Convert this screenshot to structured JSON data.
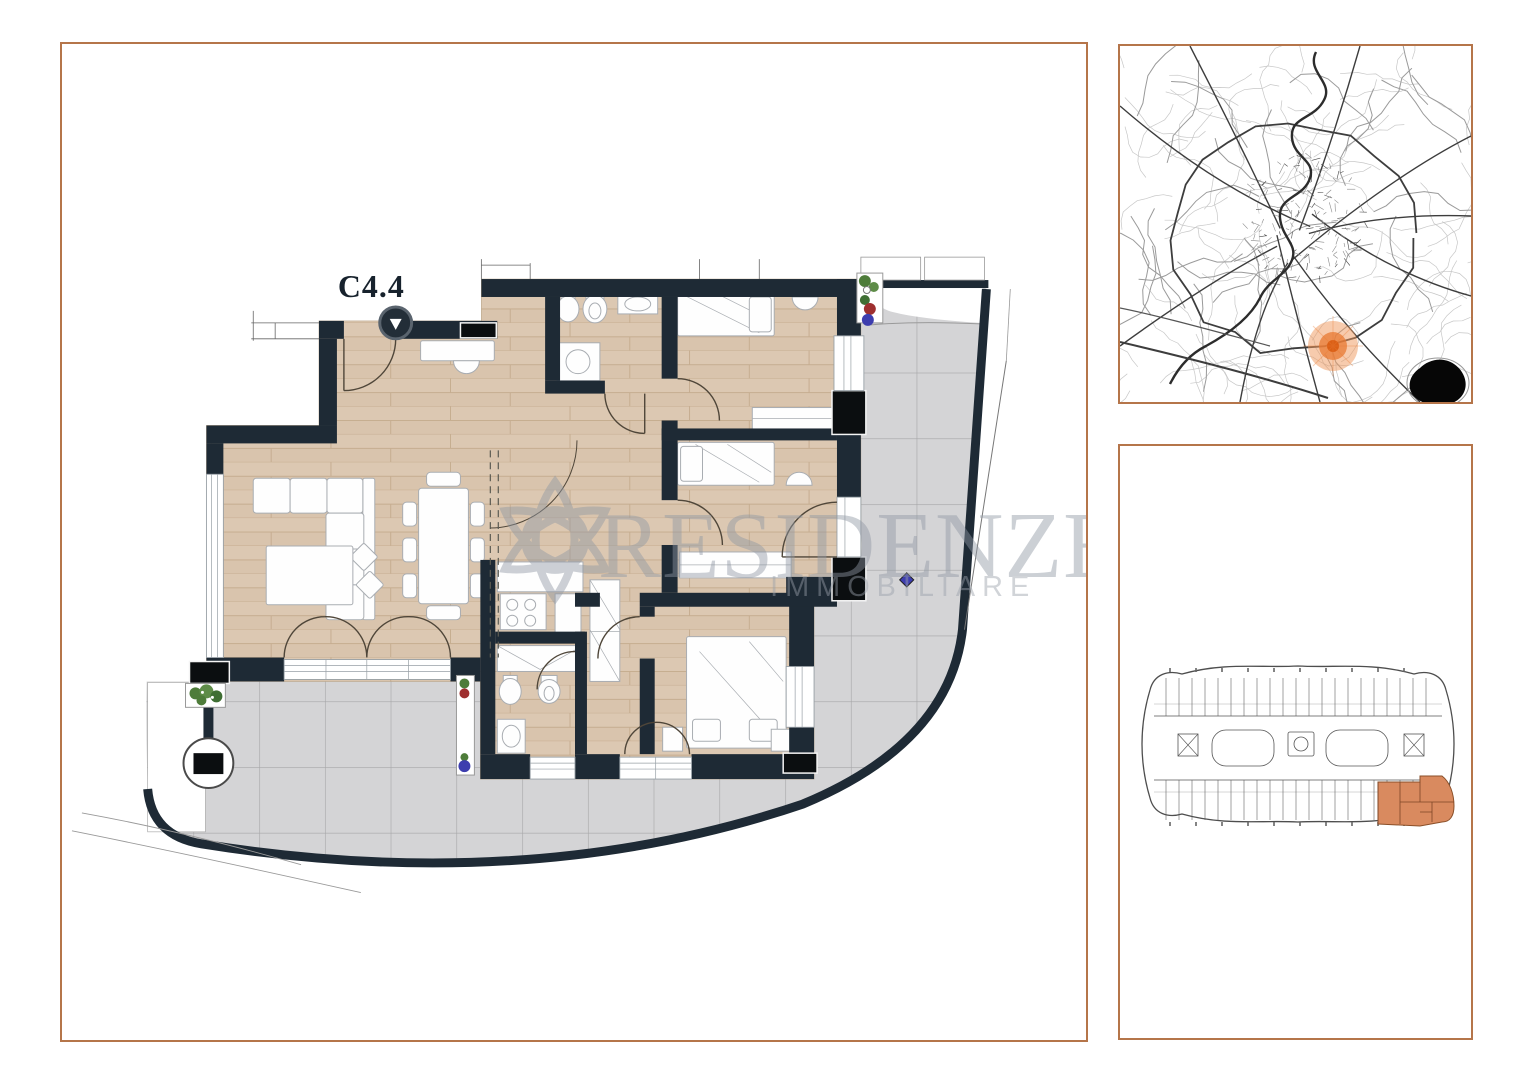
{
  "floor_plan": {
    "unit_label": "C4.4",
    "watermark": {
      "line1": "RESIDENZE",
      "line2": "IMMOBILIARE"
    },
    "features": [
      "entrance-marker",
      "sofa",
      "coffee-table",
      "dining-table",
      "kitchen-stove",
      "washing-machine",
      "shower",
      "toilet",
      "bidet",
      "sink",
      "single-bed",
      "single-bed",
      "double-bed",
      "wardrobe",
      "french-doors",
      "terrace-tiles",
      "planters",
      "round-column"
    ]
  },
  "city_map": {
    "highlight_marker_color": "#e87a33",
    "marker_halo_color": "#f0985c",
    "lake_color": "#060606",
    "road_color_main": "#3d3d3d",
    "road_color_minor": "#c7c7c7",
    "river_color": "#2c2c2c"
  },
  "key_plan": {
    "highlight_color": "#d98a5f",
    "outline_color": "#4e4e4e"
  },
  "colors": {
    "panel_border": "#b5754a",
    "walls": "#1e2a35",
    "structural_black": "#0b0e10",
    "wood_floor": "#dcc8b2",
    "wood_line": "#c6ad90",
    "terrace_tile": "#d4d4d6",
    "tile_line": "#a6a6a8",
    "furniture_stroke": "#a9adb2",
    "door_arc": "#4f4639",
    "watermark_gray": "#9098a4",
    "plant_green": "#4e7c3a",
    "plant_red": "#9e2f2f",
    "plant_blue": "#3d3dae"
  }
}
